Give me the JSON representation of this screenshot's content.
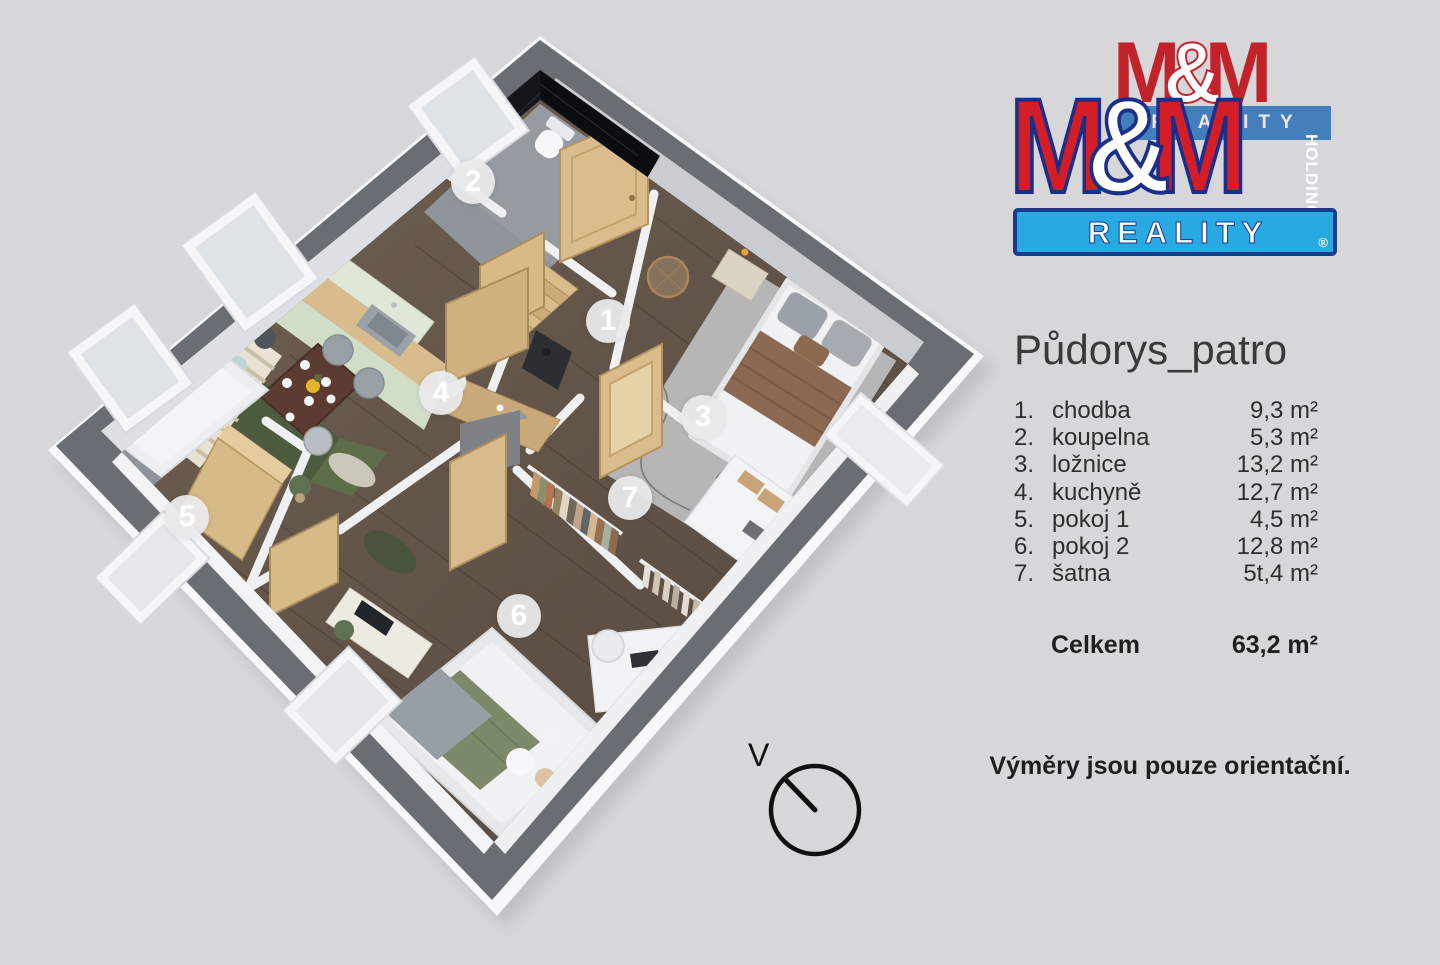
{
  "logo": {
    "back": {
      "m1": "M",
      "amp": "&",
      "m2": "M",
      "bar_text": "REALITY"
    },
    "front": {
      "m1": "M",
      "amp": "&",
      "m2": "M",
      "holding": "HOLDING",
      "banner_text": "REALITY",
      "registered": "®"
    },
    "colors": {
      "red": "#d41e27",
      "navy": "#1b2f8a",
      "light_blue": "#29a9e1"
    }
  },
  "panel": {
    "title": "Půdorys_patro",
    "rooms": [
      {
        "num": "1.",
        "name": "chodba",
        "area": "9,3 m²"
      },
      {
        "num": "2.",
        "name": "koupelna",
        "area": "5,3 m²"
      },
      {
        "num": "3.",
        "name": "ložnice",
        "area": "13,2 m²"
      },
      {
        "num": "4.",
        "name": "kuchyně",
        "area": "12,7 m²"
      },
      {
        "num": "5.",
        "name": "pokoj 1",
        "area": "4,5 m²"
      },
      {
        "num": "6.",
        "name": "pokoj 2",
        "area": "12,8 m²"
      },
      {
        "num": "7.",
        "name": "šatna",
        "area": "5t,4 m²"
      }
    ],
    "total_label": "Celkem",
    "total_area": "63,2 m²",
    "disclaimer": "Výměry jsou pouze orientační."
  },
  "floorplan": {
    "compass_label": "V",
    "markers": [
      {
        "n": "1",
        "x": 608,
        "y": 321
      },
      {
        "n": "2",
        "x": 473,
        "y": 182
      },
      {
        "n": "3",
        "x": 703,
        "y": 417
      },
      {
        "n": "4",
        "x": 441,
        "y": 393
      },
      {
        "n": "5",
        "x": 187,
        "y": 517
      },
      {
        "n": "6",
        "x": 519,
        "y": 616
      },
      {
        "n": "7",
        "x": 630,
        "y": 498
      }
    ],
    "colors": {
      "outer_wall": "#696e75",
      "floor_wood": "#665849",
      "bath_tile": "#101214",
      "kitchen_mint": "#dfe8d7",
      "door_wood": "#d9bd8c"
    }
  }
}
